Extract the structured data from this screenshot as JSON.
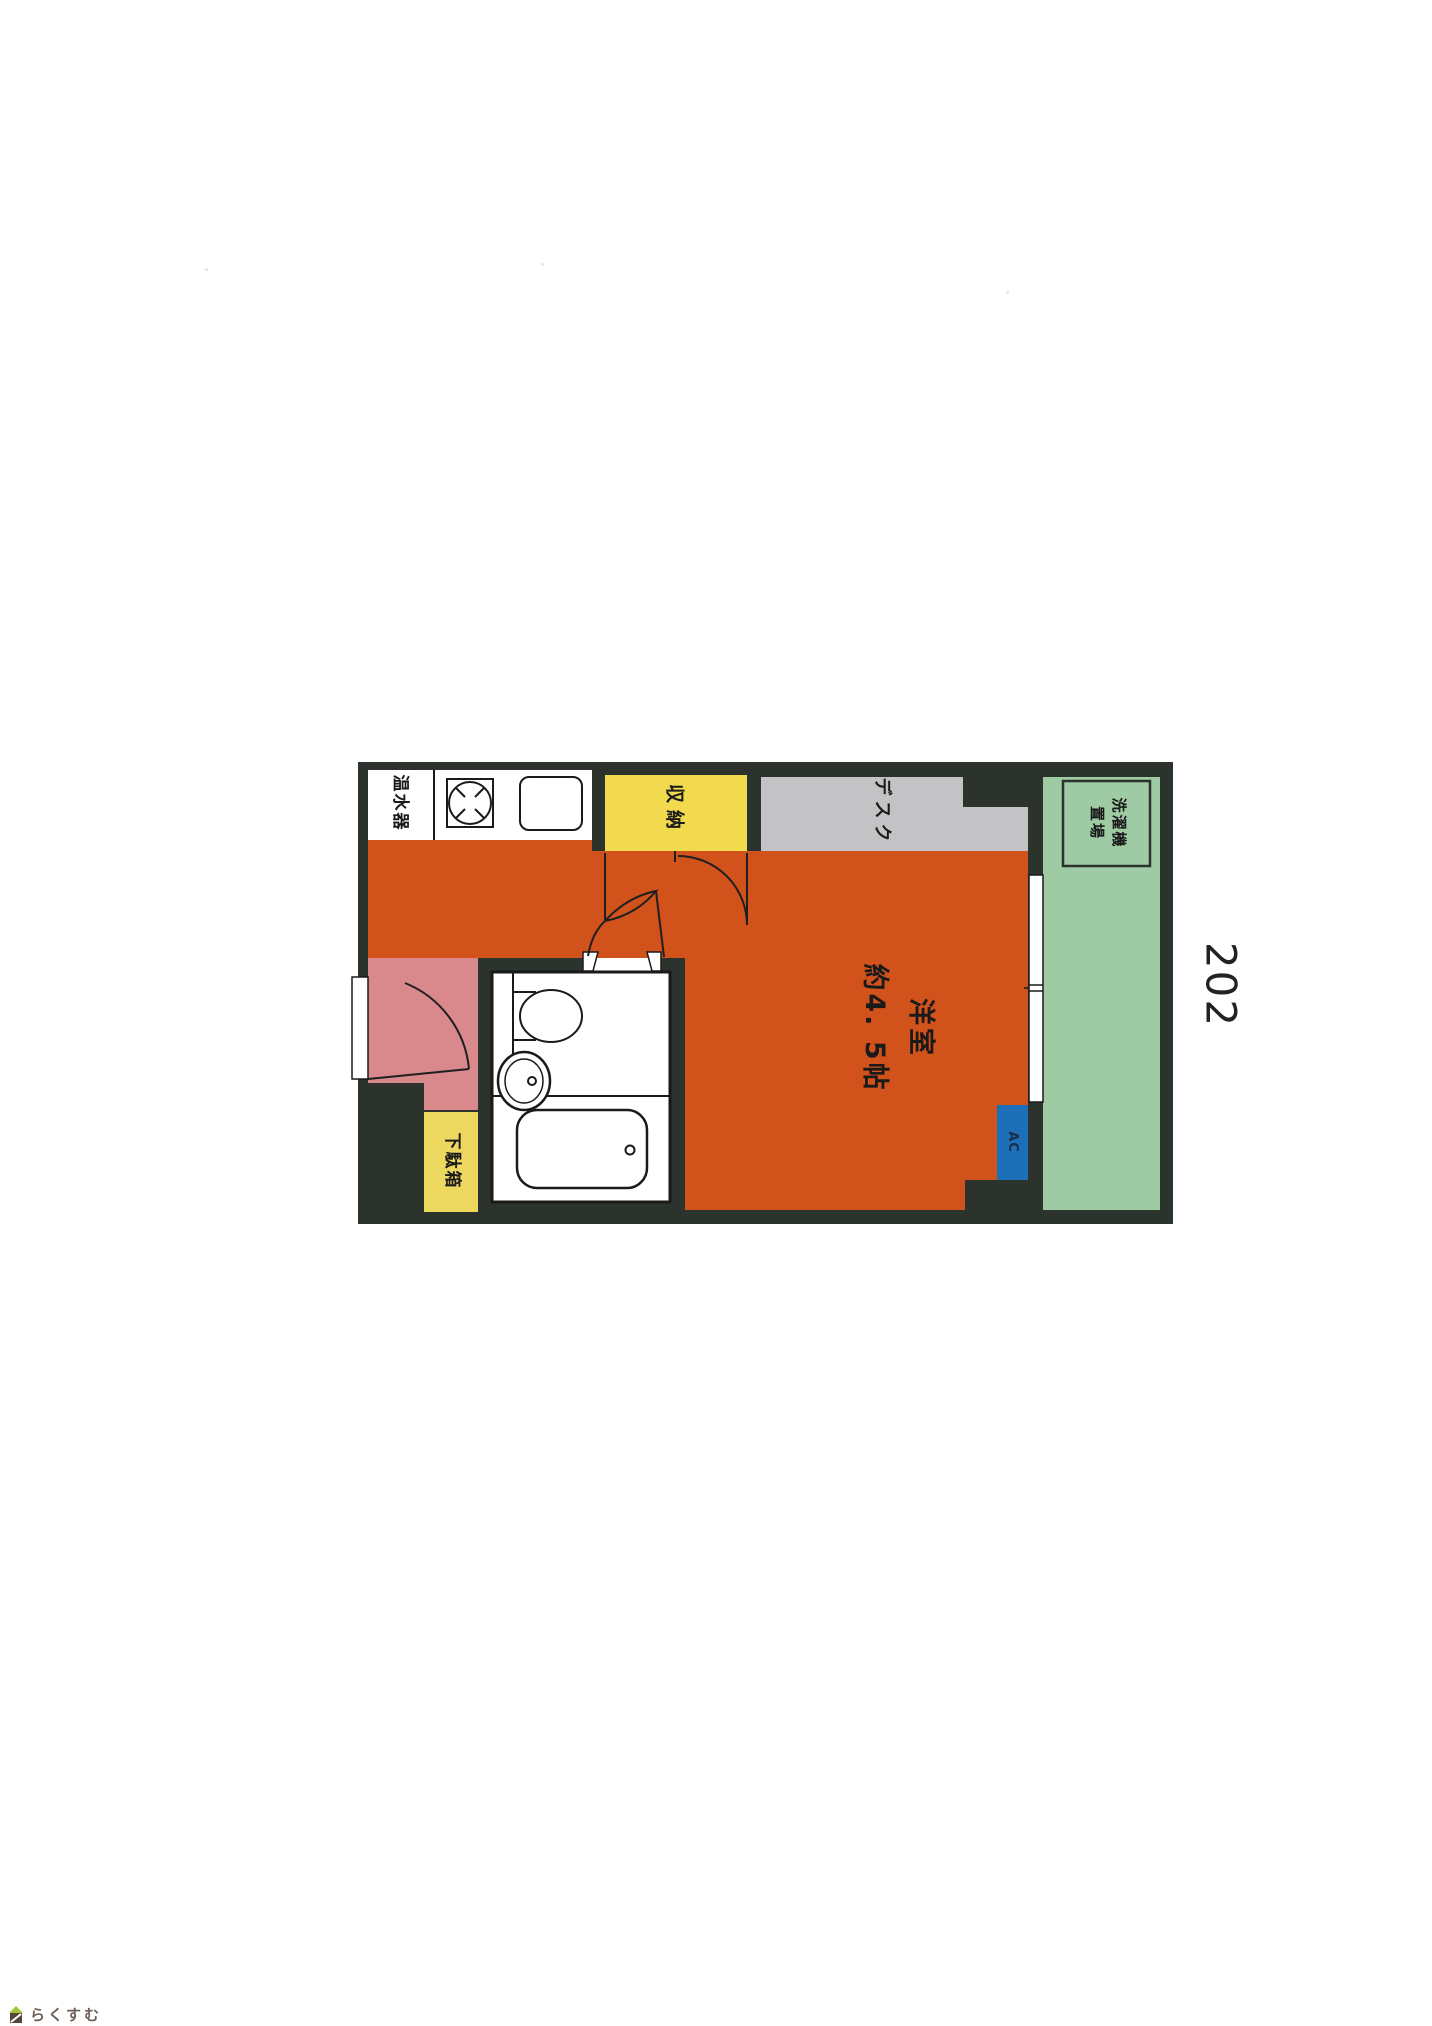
{
  "unit_number": "202",
  "watermark": "らくすむ",
  "labels": {
    "water_heater": "温水器",
    "closet": "収納",
    "desk": "デスク",
    "washer": "洗濯機\n置場",
    "main_room": "洋室\n約4. 5帖",
    "shoe_box": "下駄箱",
    "ac": "AC"
  },
  "colors": {
    "wall": "#2b332c",
    "room_orange": "#d2521c",
    "closet_yellow": "#f2da4f",
    "shoebox_yellow": "#ecd75f",
    "desk_gray": "#c3c3c5",
    "balcony_green": "#9fcba4",
    "entry_pink": "#d9898c",
    "ac_blue": "#1d6fb8",
    "ac_text": "#1a2e4a",
    "fixture_white": "#ffffff",
    "logo_green": "#a5c63b",
    "logo_brown": "#55463a",
    "logo_text_color": "#6f6057"
  }
}
